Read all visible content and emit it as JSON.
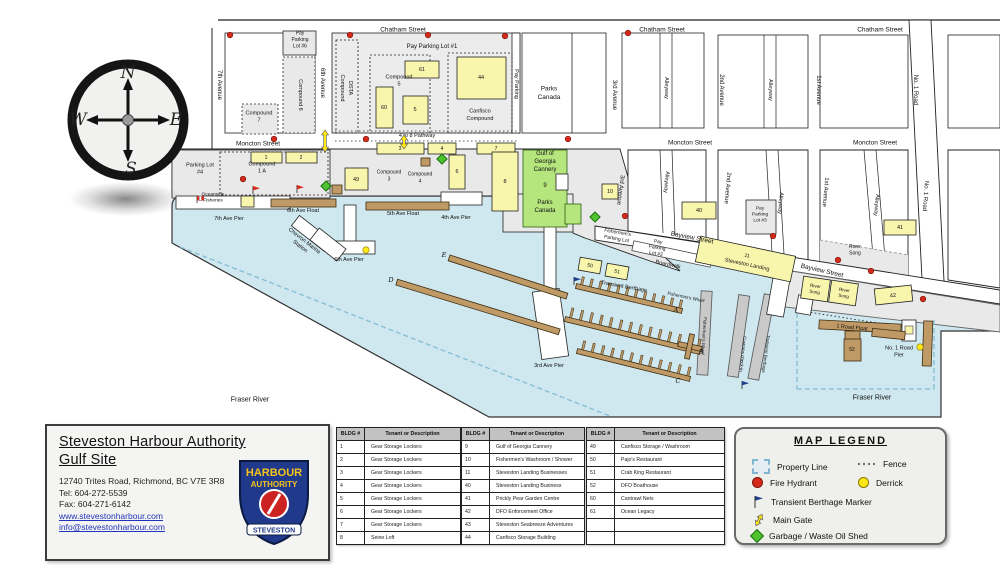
{
  "compass": {
    "n": "N",
    "e": "E",
    "s": "S",
    "w": "W"
  },
  "colors": {
    "water": "#cfe7ef",
    "land_gray": "#e9e9e9",
    "block_gray": "#ececec",
    "white": "#ffffff",
    "building": "#f8f5ac",
    "float": "#c09a66",
    "float_stroke": "#3d2e12",
    "cannery_green": "#b5e57d",
    "hydrant": "#d5291c",
    "derrick": "#ffe816",
    "shed_green": "#4fc32e",
    "flag_navy": "#1d3f8f",
    "property_dash": "#85bdd3",
    "walk_gray": "#c9c9c9"
  },
  "map": {
    "streets": {
      "chatham": "Chatham Street",
      "moncton": "Moncton Street",
      "bay­view": "Bayview Street",
      "bayview": "Bayview Street",
      "ave7": "7th Avenue",
      "ave6": "6th Avenue",
      "ave3": "3rd Avenue",
      "ave2": "2nd Avenue",
      "ave1": "1st Avenue",
      "no1road": "No. 1 Road",
      "alleyway": "Alleyway"
    },
    "areas": {
      "pay_lot1": "Pay Parking Lot #1",
      "pay_lot6": [
        "Pay",
        "Parking",
        "Lot #6"
      ],
      "pay_lot2": [
        "Pay",
        "Parking",
        "Lot #2"
      ],
      "pay_lot3": [
        "Pay",
        "Parking",
        "Lot #3"
      ],
      "parking_lot4": [
        "Parking Lot",
        "#4"
      ],
      "pathway": "4 to 8 Pathway",
      "parks_canada": [
        "Parks",
        "Canada"
      ],
      "dsta": [
        "DSTA",
        "Compound"
      ],
      "compound5": [
        "Compound",
        "5"
      ],
      "compound6": "Compound 6",
      "compound7": [
        "Compound",
        "7"
      ],
      "compound1a": [
        "Compound",
        "1 A"
      ],
      "compound3": [
        "Compound",
        "3"
      ],
      "compound4": [
        "Compound",
        "4"
      ],
      "canfisco": [
        "Canfisco",
        "Compound"
      ],
      "pay_parking": "Pay Parking",
      "oceanside": [
        "Oceanside",
        "Fisheries"
      ],
      "fishermens_lot": [
        "Fishermen's",
        "Parking Lot"
      ],
      "gulf": [
        "Gulf of",
        "Georgia",
        "Cannery"
      ],
      "gulf_num": "9",
      "gulf_parks": [
        "Parks",
        "Canada"
      ],
      "boardwalk": "Boardwalk",
      "landing_num": "11",
      "landing": "Steveston Landing",
      "river_song": [
        "River",
        "Song"
      ],
      "transient": "Transient Berthage",
      "fw": "Fisherman's Wharf",
      "customs": "Customs check-in",
      "chevron": [
        "Chevron Marine",
        "Station"
      ],
      "fraser": "Fraser River"
    },
    "waterfront": {
      "pier7": "7th Ave Pier",
      "float6": "6th Ave Float",
      "float5": "5th Ave Float",
      "pier4": "4th Ave Pier",
      "pier6": "6th Ave Pier",
      "pier3": "3rd Ave Pier",
      "road_float": "1 Road Float",
      "no1pier": [
        "No. 1 Road",
        "Pier"
      ],
      "dockA": "A",
      "dockB": "B",
      "dockC": "C",
      "dockD": "D",
      "dockE": "E"
    },
    "building_numbers": {
      "b1": "1",
      "b2": "2",
      "b3": "3",
      "b4": "4",
      "b5": "5",
      "b6": "6",
      "b7": "7",
      "b8": "8",
      "b10": "10",
      "b40": "40",
      "b41": "41",
      "b42": "42",
      "b44": "44",
      "b49": "49",
      "b50": "50",
      "b51": "51",
      "b52": "52",
      "b60": "60",
      "b61": "61"
    }
  },
  "info_card": {
    "title_line1": "Steveston Harbour Authority",
    "title_line2": "Gulf Site",
    "address": "12740 Trites Road, Richmond, BC V7E 3R8",
    "tel": "Tel: 604-272-5539",
    "fax": "Fax: 604-271-6142",
    "website": "www.stevestonharbour.com",
    "email": "info@stevestonharbour.com",
    "badge": {
      "line1": "HARBOUR",
      "line2": "AUTHORITY",
      "banner": "STEVESTON"
    }
  },
  "tables": {
    "headers": [
      "BLDG #",
      "Tenant or Description"
    ],
    "t1": [
      [
        "1",
        "Gear Storage Lockers"
      ],
      [
        "2",
        "Gear Storage Lockers"
      ],
      [
        "3",
        "Gear Storage Lockers"
      ],
      [
        "4",
        "Gear Storage Lockers"
      ],
      [
        "5",
        "Gear Storage Lockers"
      ],
      [
        "6",
        "Gear Storage Lockers"
      ],
      [
        "7",
        "Gear Storage Lockers"
      ],
      [
        "8",
        "Seine Loft"
      ]
    ],
    "t2": [
      [
        "9",
        "Gulf of Georgia Cannery"
      ],
      [
        "10",
        "Fishermen's Washroom / Shower"
      ],
      [
        "11",
        "Steveston Landing Businesses"
      ],
      [
        "40",
        "Steveston Landing Business"
      ],
      [
        "41",
        "Prickly Pear Garden Centre"
      ],
      [
        "42",
        "DFO Enforcement Office"
      ],
      [
        "43",
        "Steveston Seabreeze Adventures"
      ],
      [
        "44",
        "Canfisco Storage Building"
      ]
    ],
    "t3": [
      [
        "49",
        "Canfisco Storage / Washroom"
      ],
      [
        "50",
        "Pajo's Restaurant"
      ],
      [
        "51",
        "Crab King Restaurant"
      ],
      [
        "52",
        "DFO Boathouse"
      ],
      [
        "60",
        "Cantrawl Nets"
      ],
      [
        "61",
        "Ocean Legacy"
      ],
      [
        "",
        ""
      ],
      [
        "",
        ""
      ]
    ]
  },
  "legend": {
    "title": "MAP LEGEND",
    "items": [
      {
        "icon": "property-line",
        "label": "Property Line"
      },
      {
        "icon": "fence",
        "label": "Fence"
      },
      {
        "icon": "fire-hydrant",
        "label": "Fire Hydrant"
      },
      {
        "icon": "derrick",
        "label": "Derrick"
      },
      {
        "icon": "berthage-flag",
        "label": "Transient Berthage Marker"
      },
      {
        "icon": "main-gate",
        "label": "Main Gate"
      },
      {
        "icon": "garbage-shed",
        "label": "Garbage / Waste Oil Shed"
      }
    ]
  }
}
